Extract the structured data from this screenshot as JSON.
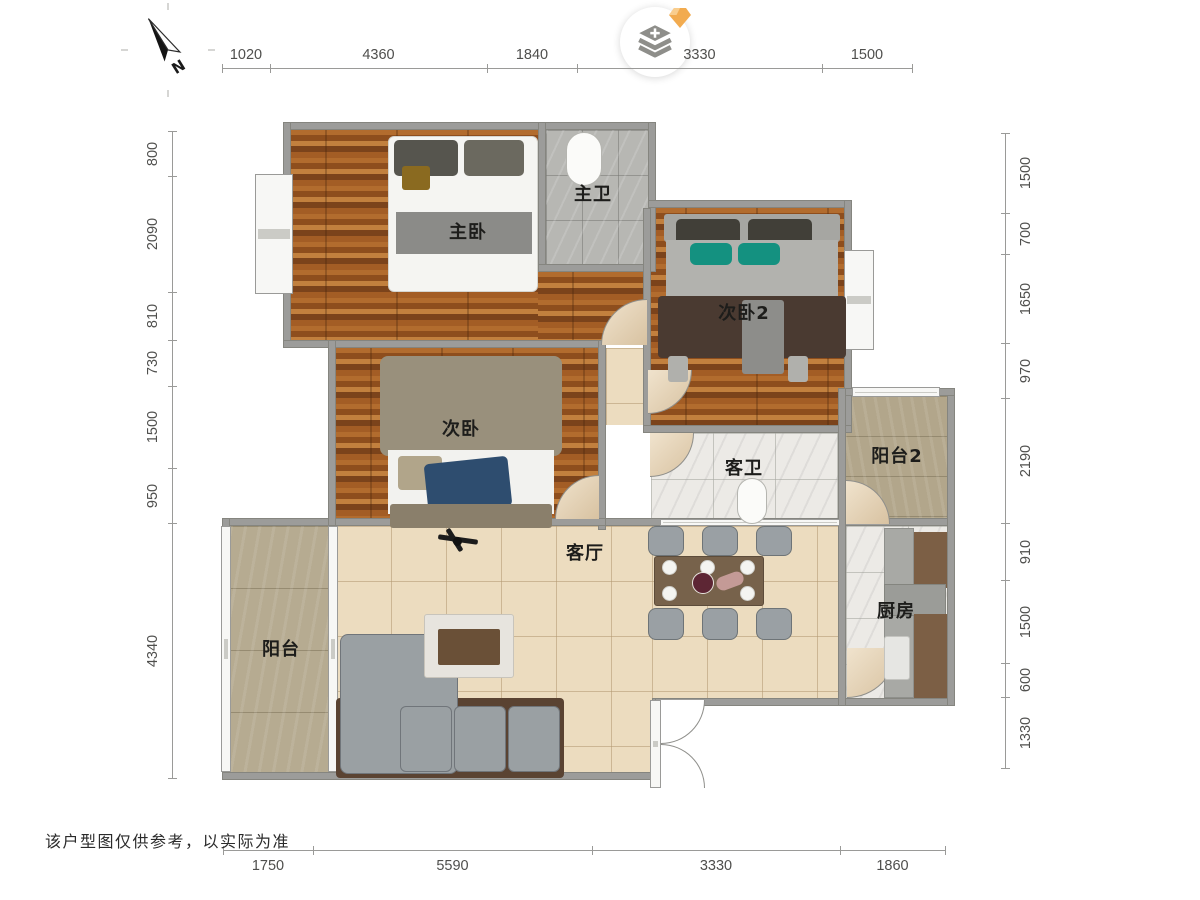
{
  "meta": {
    "disclaimer": "该户型图仅供参考，以实际为准"
  },
  "compass": {
    "north_label": "N"
  },
  "dimensions": {
    "top": {
      "orient": "h",
      "line_y": 68,
      "label_offset": -13,
      "segments": [
        {
          "label": "1020",
          "from": 222,
          "to": 270
        },
        {
          "label": "4360",
          "from": 270,
          "to": 487
        },
        {
          "label": "1840",
          "from": 487,
          "to": 577
        },
        {
          "label": "3330",
          "from": 577,
          "to": 822
        },
        {
          "label": "1500",
          "from": 822,
          "to": 912
        }
      ]
    },
    "bottom": {
      "orient": "h",
      "line_y": 850,
      "label_offset": 16,
      "segments": [
        {
          "label": "1750",
          "from": 223,
          "to": 313
        },
        {
          "label": "5590",
          "from": 313,
          "to": 592
        },
        {
          "label": "3330",
          "from": 592,
          "to": 840
        },
        {
          "label": "1860",
          "from": 840,
          "to": 945
        }
      ]
    },
    "left": {
      "orient": "v",
      "line_x": 172,
      "label_offset": -19,
      "segments": [
        {
          "label": "800",
          "from": 131,
          "to": 176
        },
        {
          "label": "2090",
          "from": 176,
          "to": 292
        },
        {
          "label": "810",
          "from": 292,
          "to": 340
        },
        {
          "label": "730",
          "from": 340,
          "to": 386
        },
        {
          "label": "1500",
          "from": 386,
          "to": 468
        },
        {
          "label": "950",
          "from": 468,
          "to": 523
        },
        {
          "label": "4340",
          "from": 523,
          "to": 778
        }
      ]
    },
    "right": {
      "orient": "v",
      "line_x": 1005,
      "label_offset": 21,
      "segments": [
        {
          "label": "1500",
          "from": 133,
          "to": 213
        },
        {
          "label": "700",
          "from": 213,
          "to": 254
        },
        {
          "label": "1650",
          "from": 254,
          "to": 343
        },
        {
          "label": "970",
          "from": 343,
          "to": 398
        },
        {
          "label": "2190",
          "from": 398,
          "to": 523
        },
        {
          "label": "910",
          "from": 523,
          "to": 580
        },
        {
          "label": "1500",
          "from": 580,
          "to": 663
        },
        {
          "label": "600",
          "from": 663,
          "to": 697
        },
        {
          "label": "1330",
          "from": 697,
          "to": 768
        }
      ]
    }
  },
  "plan": {
    "colors": {
      "wall": "#9c9c9a",
      "window": "#f7f7f5",
      "door_tan": "#e8d7bd",
      "teal": "#149180",
      "navy": "#2e4d6f"
    },
    "rooms": [
      {
        "id": "master-bedroom",
        "label": "主卧",
        "x": 291,
        "y": 130,
        "w": 247,
        "h": 212,
        "floor": "wood",
        "label_x": 468,
        "label_y": 231
      },
      {
        "id": "master-bedroom-ext",
        "label": "",
        "x": 538,
        "y": 272,
        "w": 110,
        "h": 70,
        "floor": "wood",
        "label_x": 0,
        "label_y": 0
      },
      {
        "id": "master-bath",
        "label": "主卫",
        "x": 546,
        "y": 130,
        "w": 102,
        "h": 136,
        "floor": "graytile",
        "label_x": 593,
        "label_y": 193
      },
      {
        "id": "bedroom-2",
        "label": "次卧2",
        "x": 651,
        "y": 208,
        "w": 193,
        "h": 217,
        "floor": "wood",
        "label_x": 744,
        "label_y": 312
      },
      {
        "id": "hallway",
        "label": "",
        "x": 606,
        "y": 348,
        "w": 37,
        "h": 77,
        "floor": "beige",
        "label_x": 0,
        "label_y": 0
      },
      {
        "id": "bedroom",
        "label": "次卧",
        "x": 336,
        "y": 348,
        "w": 262,
        "h": 170,
        "floor": "wood",
        "label_x": 461,
        "label_y": 428
      },
      {
        "id": "guest-bath",
        "label": "客卫",
        "x": 651,
        "y": 433,
        "w": 187,
        "h": 85,
        "floor": "marble",
        "label_x": 744,
        "label_y": 467
      },
      {
        "id": "balcony-2",
        "label": "阳台2",
        "x": 846,
        "y": 396,
        "w": 101,
        "h": 122,
        "floor": "tan2",
        "label_x": 897,
        "label_y": 455
      },
      {
        "id": "living-room",
        "label": "客厅",
        "x": 336,
        "y": 526,
        "w": 316,
        "h": 246,
        "floor": "beige",
        "label_x": 585,
        "label_y": 552
      },
      {
        "id": "dining-area",
        "label": "",
        "x": 652,
        "y": 526,
        "w": 186,
        "h": 172,
        "floor": "beige",
        "label_x": 0,
        "label_y": 0
      },
      {
        "id": "balcony",
        "label": "阳台",
        "x": 230,
        "y": 526,
        "w": 100,
        "h": 246,
        "floor": "tan",
        "label_x": 281,
        "label_y": 648
      },
      {
        "id": "kitchen",
        "label": "厨房",
        "x": 846,
        "y": 526,
        "w": 101,
        "h": 172,
        "floor": "marble",
        "label_x": 896,
        "label_y": 610
      }
    ],
    "walls": [
      [
        283,
        122,
        373,
        8
      ],
      [
        283,
        122,
        8,
        226
      ],
      [
        538,
        122,
        8,
        150
      ],
      [
        538,
        264,
        118,
        8
      ],
      [
        648,
        122,
        8,
        150
      ],
      [
        648,
        200,
        204,
        8
      ],
      [
        844,
        200,
        8,
        232
      ],
      [
        643,
        208,
        8,
        224
      ],
      [
        283,
        340,
        323,
        8
      ],
      [
        598,
        340,
        8,
        190
      ],
      [
        643,
        425,
        209,
        8
      ],
      [
        595,
        518,
        360,
        8
      ],
      [
        222,
        518,
        384,
        8
      ],
      [
        222,
        518,
        8,
        262
      ],
      [
        222,
        772,
        438,
        8
      ],
      [
        652,
        698,
        8,
        90
      ],
      [
        655,
        698,
        300,
        8
      ],
      [
        947,
        388,
        8,
        318
      ],
      [
        838,
        388,
        117,
        8
      ],
      [
        838,
        388,
        8,
        318
      ],
      [
        328,
        340,
        8,
        186
      ]
    ],
    "windows": [
      {
        "id": "bay-window-master",
        "x": 255,
        "y": 174,
        "w": 38,
        "h": 120
      },
      {
        "id": "bay-window-bedroom2",
        "x": 844,
        "y": 250,
        "w": 30,
        "h": 100
      },
      {
        "id": "window-balcony2-top",
        "x": 852,
        "y": 387,
        "w": 88,
        "h": 10
      },
      {
        "id": "window-dining-top",
        "x": 660,
        "y": 519,
        "w": 180,
        "h": 7
      },
      {
        "id": "glass-balcony-living",
        "x": 328,
        "y": 526,
        "w": 10,
        "h": 246
      },
      {
        "id": "glass-balcony-outer",
        "x": 221,
        "y": 526,
        "w": 10,
        "h": 246
      },
      {
        "id": "entry-door-leaf",
        "x": 650,
        "y": 700,
        "w": 11,
        "h": 88
      }
    ],
    "doors": [
      {
        "id": "door-master-bedroom",
        "x": 601,
        "y": 299,
        "s": 46,
        "corner": "tl",
        "fill": "tan"
      },
      {
        "id": "door-bedroom-2",
        "x": 648,
        "y": 370,
        "s": 44,
        "corner": "br",
        "fill": "tan"
      },
      {
        "id": "door-bedroom",
        "x": 555,
        "y": 475,
        "s": 44,
        "corner": "tl",
        "fill": "tan"
      },
      {
        "id": "door-guest-bath",
        "x": 650,
        "y": 433,
        "s": 44,
        "corner": "br",
        "fill": "tan"
      },
      {
        "id": "door-balcony-2",
        "x": 846,
        "y": 480,
        "s": 44,
        "corner": "tr",
        "fill": "tan"
      },
      {
        "id": "door-kitchen",
        "x": 847,
        "y": 648,
        "s": 50,
        "corner": "br",
        "fill": "tan"
      },
      {
        "id": "entry-door-swing-top",
        "x": 661,
        "y": 700,
        "s": 44,
        "corner": "br",
        "fill": "white"
      },
      {
        "id": "entry-door-swing-bottom",
        "x": 661,
        "y": 744,
        "s": 44,
        "corner": "tr",
        "fill": "white"
      }
    ],
    "furniture": [
      {
        "id": "bed-master",
        "x": 388,
        "y": 136,
        "w": 150,
        "h": 156,
        "bg": "#f5f5f2",
        "bc": "#d5d5d0",
        "r": 6
      },
      {
        "id": "pillow-master-left",
        "x": 394,
        "y": 140,
        "w": 64,
        "h": 36,
        "bg": "#56554e",
        "r": 5
      },
      {
        "id": "pillow-master-right",
        "x": 464,
        "y": 140,
        "w": 60,
        "h": 36,
        "bg": "#6b695f",
        "r": 5
      },
      {
        "id": "cushion-master",
        "x": 402,
        "y": 166,
        "w": 28,
        "h": 24,
        "bg": "#8a6a20",
        "r": 3
      },
      {
        "id": "blanket-master",
        "x": 396,
        "y": 212,
        "w": 136,
        "h": 42,
        "bg": "#8b8b88"
      },
      {
        "id": "toilet-master-bath",
        "x": 566,
        "y": 132,
        "w": 36,
        "h": 54,
        "bg": "#fbfbf9",
        "bc": "#b5b5b0",
        "r": 18
      },
      {
        "id": "headboard-bedroom2",
        "x": 664,
        "y": 214,
        "w": 176,
        "h": 28,
        "bg": "#a6a6a2",
        "r": 3
      },
      {
        "id": "pillow-bedroom2-left",
        "x": 676,
        "y": 219,
        "w": 64,
        "h": 26,
        "bg": "#413f38",
        "r": 5
      },
      {
        "id": "pillow-bedroom2-right",
        "x": 748,
        "y": 219,
        "w": 64,
        "h": 26,
        "bg": "#413f38",
        "r": 5
      },
      {
        "id": "sheet-bedroom2",
        "x": 666,
        "y": 240,
        "w": 172,
        "h": 64,
        "bg": "#b2b2ae"
      },
      {
        "id": "cushion-teal-left",
        "x": 690,
        "y": 243,
        "w": 42,
        "h": 22,
        "bg": "#149180",
        "r": 6
      },
      {
        "id": "cushion-teal-right",
        "x": 738,
        "y": 243,
        "w": 42,
        "h": 22,
        "bg": "#149180",
        "r": 6
      },
      {
        "id": "blanket-bedroom2",
        "x": 658,
        "y": 296,
        "w": 188,
        "h": 62,
        "bg": "#4a3a31",
        "r": 4
      },
      {
        "id": "throw-bedroom2",
        "x": 742,
        "y": 300,
        "w": 42,
        "h": 74,
        "bg": "#8d8d8a",
        "r": 3
      },
      {
        "id": "bedleg-bedroom2-left",
        "x": 668,
        "y": 356,
        "w": 20,
        "h": 26,
        "bg": "#b0b0ac",
        "r": 3
      },
      {
        "id": "bedleg-bedroom2-right",
        "x": 788,
        "y": 356,
        "w": 20,
        "h": 26,
        "bg": "#b0b0ac",
        "r": 3
      },
      {
        "id": "blanket-bedroom",
        "x": 380,
        "y": 356,
        "w": 182,
        "h": 100,
        "bg": "#99907c",
        "r": 8
      },
      {
        "id": "sheet-bedroom",
        "x": 388,
        "y": 450,
        "w": 166,
        "h": 64,
        "bg": "#f2f2ef"
      },
      {
        "id": "pillow-bedroom",
        "x": 398,
        "y": 456,
        "w": 44,
        "h": 34,
        "bg": "#b1a58a",
        "r": 4
      },
      {
        "id": "clothes-bedroom",
        "x": 426,
        "y": 460,
        "w": 84,
        "h": 50,
        "bg": "#2e4d6f",
        "r": 5,
        "rot": -6
      },
      {
        "id": "footboard-bedroom",
        "x": 390,
        "y": 504,
        "w": 162,
        "h": 24,
        "bg": "#8a7f6b",
        "r": 3
      },
      {
        "id": "sofa-frame",
        "x": 336,
        "y": 698,
        "w": 228,
        "h": 80,
        "bg": "#5a4332",
        "r": 4
      },
      {
        "id": "sofa-chaise",
        "x": 340,
        "y": 634,
        "w": 118,
        "h": 140,
        "bg": "#9aa0a3",
        "bc": "#70757a",
        "r": 8
      },
      {
        "id": "sofa-cushion-1",
        "x": 400,
        "y": 706,
        "w": 52,
        "h": 66,
        "bg": "#9aa0a3",
        "bc": "#70757a",
        "r": 6
      },
      {
        "id": "sofa-cushion-2",
        "x": 454,
        "y": 706,
        "w": 52,
        "h": 66,
        "bg": "#9aa0a3",
        "bc": "#70757a",
        "r": 6
      },
      {
        "id": "sofa-cushion-3",
        "x": 508,
        "y": 706,
        "w": 52,
        "h": 66,
        "bg": "#9aa0a3",
        "bc": "#70757a",
        "r": 6
      },
      {
        "id": "coffee-table",
        "x": 424,
        "y": 614,
        "w": 90,
        "h": 64,
        "bg": "#e7e4de",
        "bc": "#c8c4bb",
        "r": 3
      },
      {
        "id": "coffee-table-tray",
        "x": 438,
        "y": 629,
        "w": 62,
        "h": 36,
        "bg": "#6a5037",
        "r": 2
      },
      {
        "id": "dining-table",
        "x": 654,
        "y": 556,
        "w": 110,
        "h": 50,
        "bg": "#77624b",
        "bc": "#5d4c3a",
        "r": 3
      },
      {
        "id": "dining-chair-1",
        "x": 648,
        "y": 526,
        "w": 36,
        "h": 30,
        "bg": "#9aa0a4",
        "bc": "#6e7477",
        "r": 8
      },
      {
        "id": "dining-chair-2",
        "x": 702,
        "y": 526,
        "w": 36,
        "h": 30,
        "bg": "#9aa0a4",
        "bc": "#6e7477",
        "r": 8
      },
      {
        "id": "dining-chair-3",
        "x": 756,
        "y": 526,
        "w": 36,
        "h": 30,
        "bg": "#9aa0a4",
        "bc": "#6e7477",
        "r": 8
      },
      {
        "id": "dining-chair-4",
        "x": 648,
        "y": 608,
        "w": 36,
        "h": 32,
        "bg": "#9aa0a4",
        "bc": "#6e7477",
        "r": 8
      },
      {
        "id": "dining-chair-5",
        "x": 702,
        "y": 608,
        "w": 36,
        "h": 32,
        "bg": "#9aa0a4",
        "bc": "#6e7477",
        "r": 8
      },
      {
        "id": "dining-chair-6",
        "x": 756,
        "y": 608,
        "w": 36,
        "h": 32,
        "bg": "#9aa0a4",
        "bc": "#6e7477",
        "r": 8
      },
      {
        "id": "plate-1",
        "x": 662,
        "y": 560,
        "w": 15,
        "h": 15,
        "bg": "#f4f4f1",
        "bc": "#cfcfca",
        "r": 99
      },
      {
        "id": "plate-2",
        "x": 700,
        "y": 560,
        "w": 15,
        "h": 15,
        "bg": "#f4f4f1",
        "bc": "#cfcfca",
        "r": 99
      },
      {
        "id": "plate-3",
        "x": 740,
        "y": 560,
        "w": 15,
        "h": 15,
        "bg": "#f4f4f1",
        "bc": "#cfcfca",
        "r": 99
      },
      {
        "id": "plate-4",
        "x": 662,
        "y": 586,
        "w": 15,
        "h": 15,
        "bg": "#f4f4f1",
        "bc": "#cfcfca",
        "r": 99
      },
      {
        "id": "plate-5",
        "x": 740,
        "y": 586,
        "w": 15,
        "h": 15,
        "bg": "#f4f4f1",
        "bc": "#cfcfca",
        "r": 99
      },
      {
        "id": "centerpiece-flowers",
        "x": 692,
        "y": 572,
        "w": 22,
        "h": 22,
        "bg": "#5d2634",
        "bc": "#e9e6e0",
        "r": 99
      },
      {
        "id": "centerpiece-roses",
        "x": 716,
        "y": 574,
        "w": 28,
        "h": 14,
        "bg": "#c49a96",
        "r": 7,
        "rot": -20
      },
      {
        "id": "kitchen-counter",
        "x": 884,
        "y": 528,
        "w": 30,
        "h": 170,
        "bg": "#a8a9a5",
        "bc": "#8f908c"
      },
      {
        "id": "kitchen-cabinet-upper",
        "x": 914,
        "y": 532,
        "w": 33,
        "h": 56,
        "bg": "#7c5f45"
      },
      {
        "id": "kitchen-stove",
        "x": 884,
        "y": 584,
        "w": 62,
        "h": 32,
        "bg": "#9b9c98",
        "bc": "#84857f"
      },
      {
        "id": "kitchen-cabinet-lower",
        "x": 914,
        "y": 614,
        "w": 33,
        "h": 84,
        "bg": "#7c5f45"
      },
      {
        "id": "kitchen-sink",
        "x": 884,
        "y": 636,
        "w": 26,
        "h": 44,
        "bg": "#e6e6e3",
        "bc": "#c4c4c0",
        "r": 3
      },
      {
        "id": "toilet-guest-bath",
        "x": 737,
        "y": 478,
        "w": 30,
        "h": 46,
        "bg": "#fbfbf9",
        "bc": "#b5b5b0",
        "r": 15
      },
      {
        "id": "ceiling-fan-blade-1",
        "x": 438,
        "y": 537,
        "w": 40,
        "h": 5,
        "bg": "#1c1c1c",
        "r": 2,
        "rot": 8
      },
      {
        "id": "ceiling-fan-blade-2",
        "x": 452,
        "y": 527,
        "w": 5,
        "h": 26,
        "bg": "#1c1c1c",
        "r": 2,
        "rot": -32
      },
      {
        "id": "ceiling-fan-hub",
        "x": 453,
        "y": 537,
        "w": 9,
        "h": 9,
        "bg": "#111111",
        "r": 99
      }
    ]
  }
}
